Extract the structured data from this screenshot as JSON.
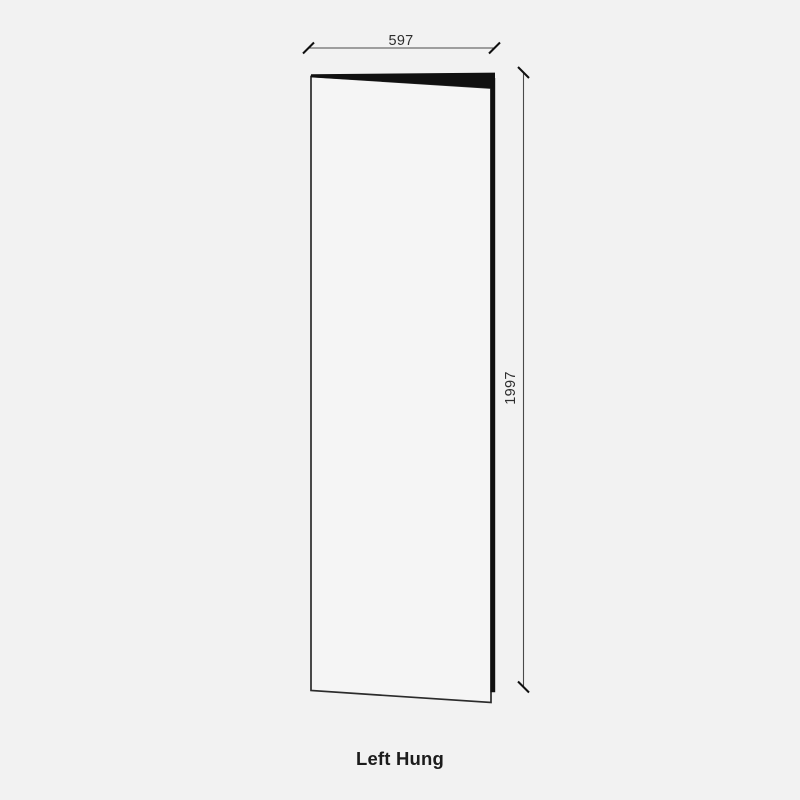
{
  "diagram": {
    "caption": "Left Hung",
    "door": {
      "width_label": "597",
      "height_label": "1997"
    },
    "colors": {
      "background": "#f2f2f2",
      "ink": "#101010",
      "outline": "#2b2b2b",
      "dimension_line": "#4a4a4a",
      "dimension_text": "#2e2e2e",
      "face_fill": "#f5f5f5"
    }
  }
}
